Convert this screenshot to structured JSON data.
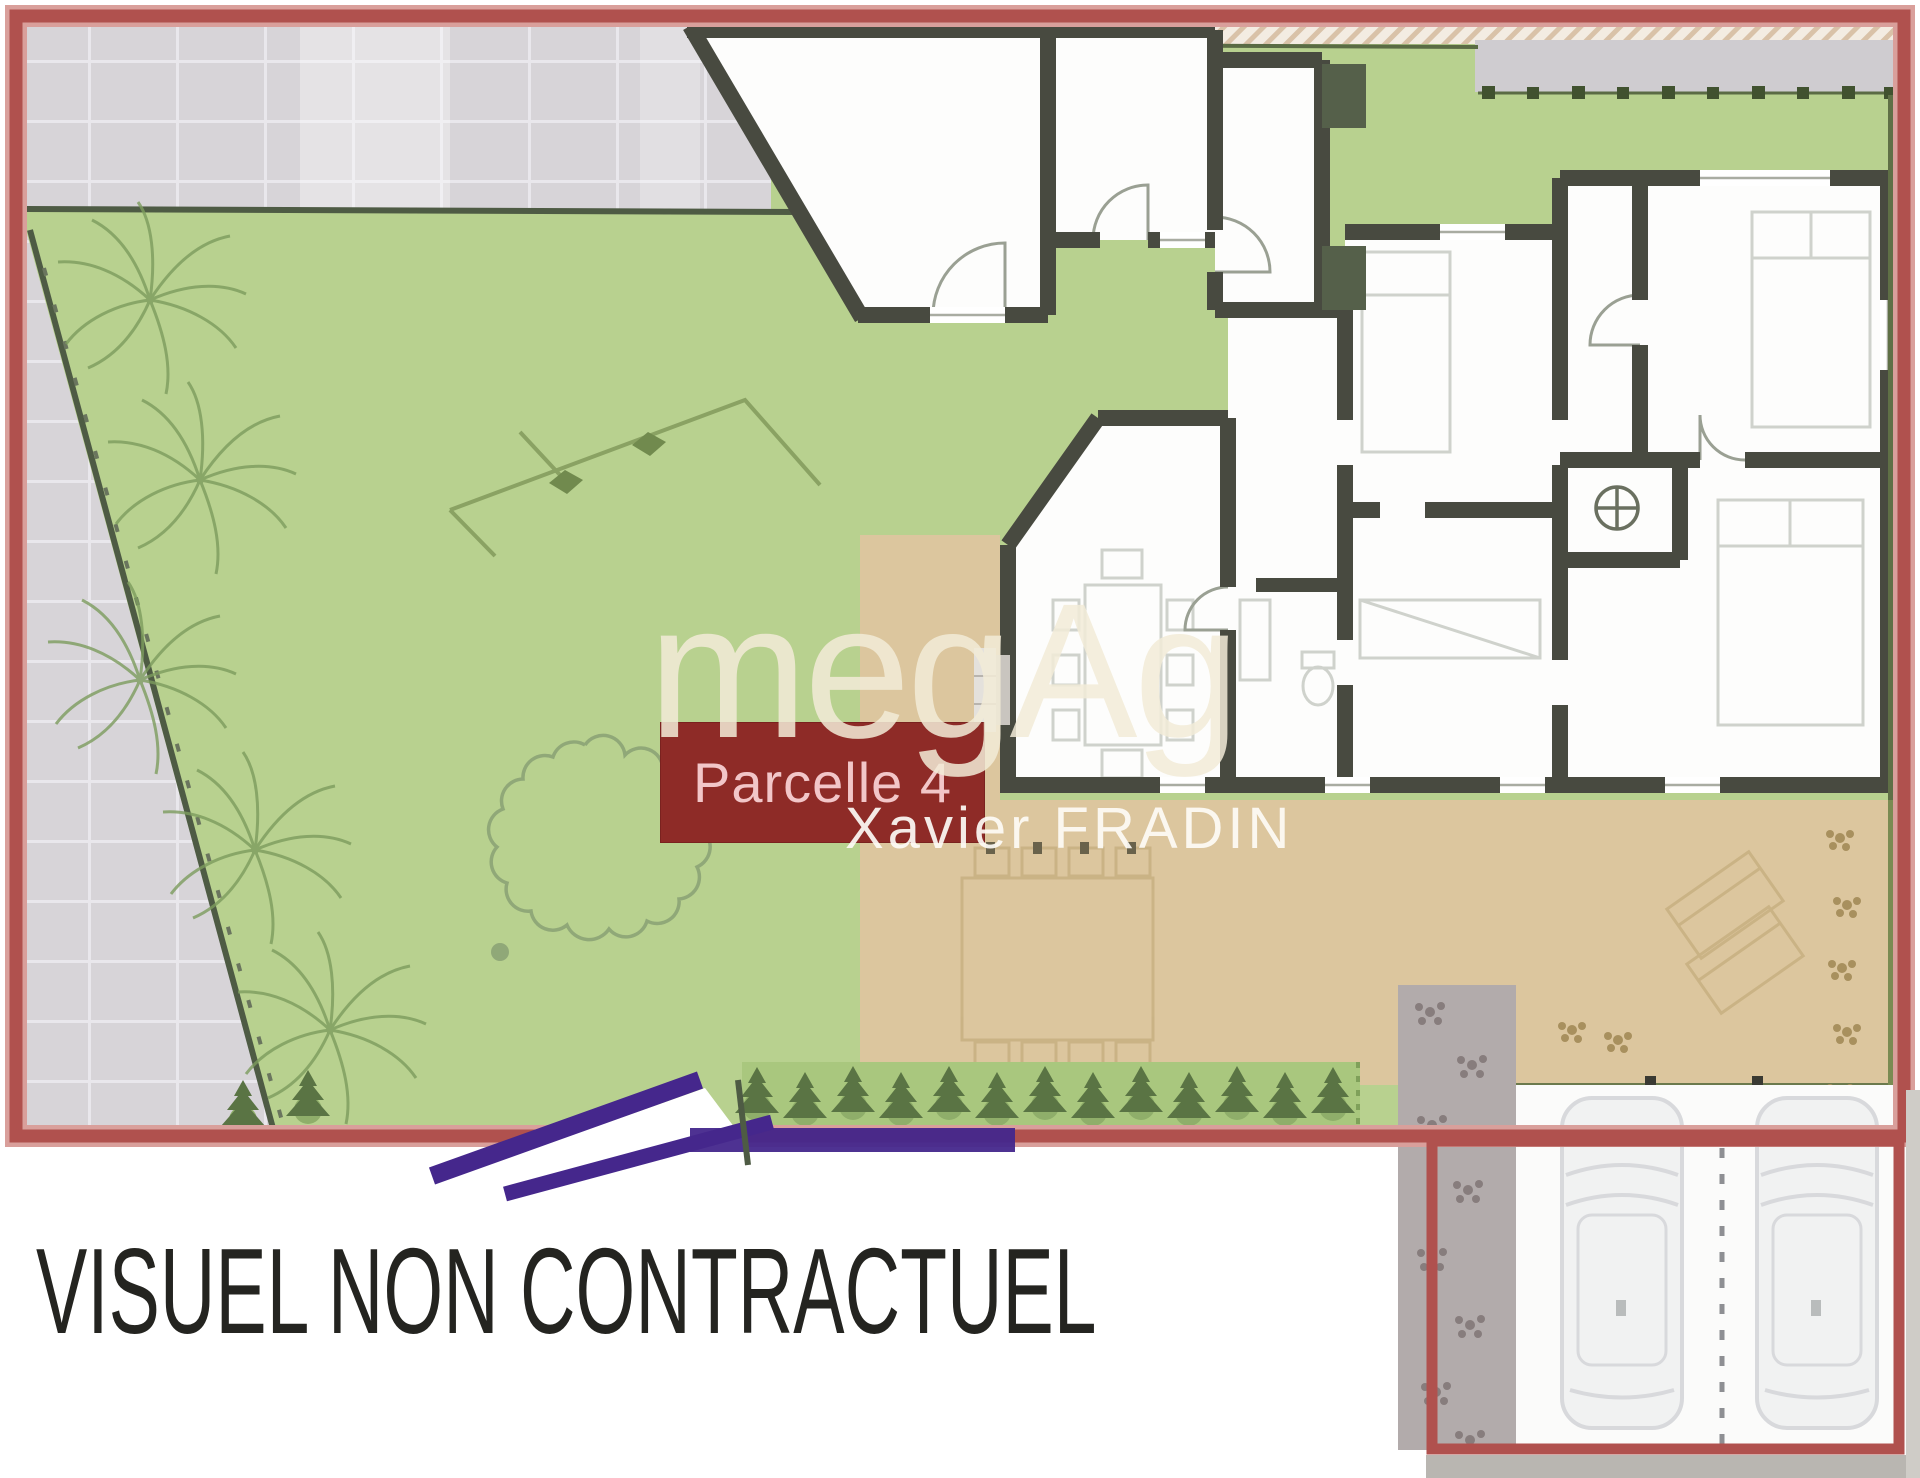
{
  "texts": {
    "parcel_label": "Parcelle 4",
    "watermark_brand": "megAg",
    "watermark_agent": "Xavier FRADIN",
    "disclaimer": "VISUEL NON CONTRACTUEL"
  },
  "colors": {
    "frame_red": "#b0514e",
    "frame_red_light": "#d99f9b",
    "label_maroon": "#8e2b27",
    "label_text_pink": "#f2c6c8",
    "lawn_green": "#b8d18f",
    "terrace_tan": "#dcc69e",
    "bush_strip_green": "#a9c77e",
    "hedge_dark_green": "#5a7444",
    "pavement_gray": "#d7d4d8",
    "pavement_grid": "#e9e7ec",
    "wall_dark": "#484a40",
    "boundary_olive": "#4e5b44",
    "path_purple": "#45278c",
    "stepping_gray": "#b2abab",
    "stepping_dot_gray": "#877d7d",
    "car_body": "#f1f2f2",
    "car_line": "#d8d9dc",
    "furniture_line": "#cfd2cc",
    "terrace_furniture": "#c9b183",
    "watermark_cream": "#f3ecd8",
    "disclaimer_black": "#242420"
  }
}
